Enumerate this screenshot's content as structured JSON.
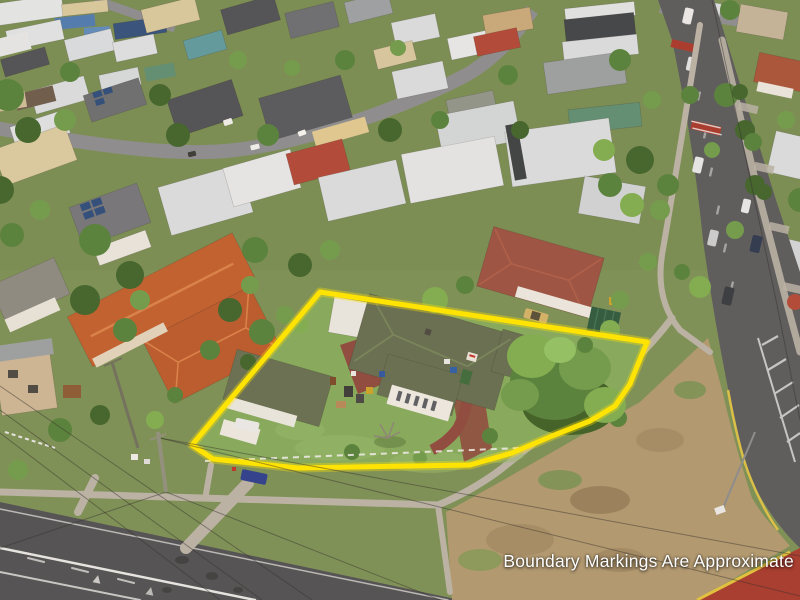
{
  "image": {
    "kind": "aerial-drone-photograph",
    "subject": "Suburban corner property outlined with a yellow boundary marking",
    "width": 800,
    "height": 600
  },
  "overlay": {
    "disclaimer": "Boundary Markings Are Approximate"
  },
  "boundary": {
    "points": "320,292 647,342 630,384 615,406 590,421 552,436 512,453 470,465 298,468 213,459 192,445",
    "color": "#ffe600"
  },
  "palette": {
    "yellow": "#ffe600",
    "lawn": "#84aa5d",
    "base": "#7b9158",
    "dry": "#b29a74",
    "asphalt": "#595a5f",
    "road": "#505156",
    "path": "#b8b3a8",
    "olive": "#646e52",
    "terra": "#c06030",
    "redroof": "#9a5243",
    "whiteroof": "#d9dde1",
    "darkroof": "#4e5157",
    "redpave": "#8c4a40",
    "redpatch": "#a63b30",
    "tdark": "#3f652f",
    "tmid": "#55823d",
    "tlite": "#6f9c4e",
    "tbright": "#7fae52",
    "textcol": "#ffffff"
  }
}
